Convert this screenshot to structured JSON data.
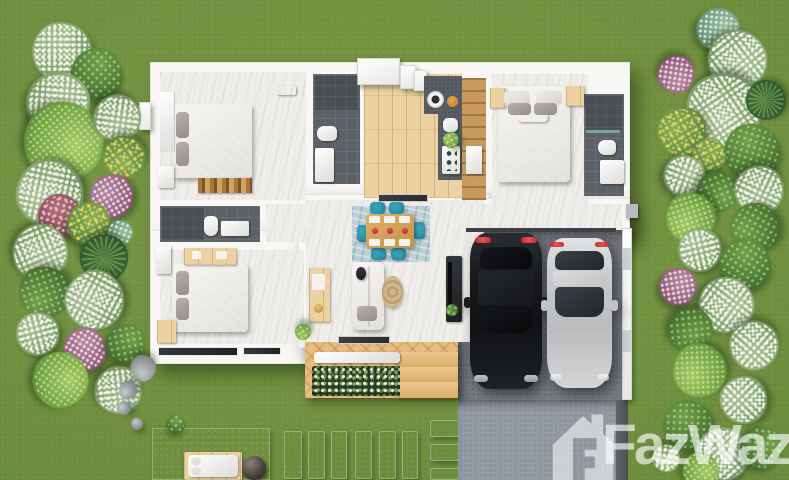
{
  "watermark": {
    "text": "FazWaz",
    "logo": "fazwaz-house-logo",
    "color": "#ffffff",
    "opacity": 0.55
  },
  "palette": {
    "grassLight": "#7a9a46",
    "grass": "#6d8d3d",
    "grassDark": "#5c7c34",
    "wall": "#f8f7f4",
    "marble": "#efeeea",
    "tile": "#5b6167",
    "wood": "#ecd2a2",
    "deck": "#e6bd80",
    "counter": "#53595f",
    "carport": "#74797f",
    "driveway": "#939aa1",
    "concrete": "#abadaf",
    "teal": "#2f93a8",
    "pantry": "#c89a5f",
    "tailRed": "#c0272d",
    "carBlack": "#16181c",
    "carSilver": "#c7c9cb",
    "jute": "#c9ad80"
  },
  "scene": {
    "type": "top-down 3d floor plan render",
    "rooms": [
      "bedroom-1",
      "bathroom-1",
      "bedroom-2",
      "bathroom-2",
      "kitchen",
      "bedroom-3",
      "ensuite-bathroom",
      "living-dining",
      "carport",
      "deck",
      "terrace"
    ],
    "vehicles": [
      "black-car",
      "silver-car"
    ]
  },
  "garden": {
    "plants": [
      [
        62,
        52,
        30,
        "white"
      ],
      [
        97,
        74,
        26,
        "green"
      ],
      [
        58,
        104,
        32,
        "white"
      ],
      [
        63,
        142,
        40,
        "bright"
      ],
      [
        117,
        118,
        24,
        "white"
      ],
      [
        124,
        157,
        22,
        "yellow"
      ],
      [
        50,
        193,
        34,
        "white"
      ],
      [
        112,
        196,
        22,
        "purple"
      ],
      [
        60,
        216,
        22,
        "purple2"
      ],
      [
        89,
        224,
        22,
        "yellow"
      ],
      [
        120,
        233,
        13,
        "teal"
      ],
      [
        40,
        252,
        28,
        "white"
      ],
      [
        104,
        258,
        24,
        "palm"
      ],
      [
        45,
        292,
        26,
        "green"
      ],
      [
        95,
        300,
        30,
        "white"
      ],
      [
        38,
        334,
        22,
        "white"
      ],
      [
        85,
        350,
        22,
        "purple"
      ],
      [
        126,
        344,
        20,
        "green"
      ],
      [
        60,
        380,
        28,
        "bright"
      ],
      [
        118,
        390,
        24,
        "white"
      ],
      [
        143,
        368,
        13,
        "rock"
      ],
      [
        128,
        390,
        9,
        "rock"
      ],
      [
        124,
        408,
        7,
        "rock"
      ],
      [
        137,
        424,
        6,
        "rock"
      ],
      [
        176,
        424,
        9,
        "green"
      ],
      [
        718,
        30,
        22,
        "teal"
      ],
      [
        737,
        60,
        30,
        "white"
      ],
      [
        676,
        74,
        19,
        "purple"
      ],
      [
        724,
        110,
        38,
        "white"
      ],
      [
        766,
        100,
        20,
        "palm"
      ],
      [
        682,
        132,
        25,
        "yellow"
      ],
      [
        752,
        152,
        28,
        "green"
      ],
      [
        709,
        155,
        17,
        "yellow"
      ],
      [
        684,
        176,
        21,
        "white"
      ],
      [
        717,
        192,
        21,
        "green"
      ],
      [
        759,
        190,
        25,
        "white"
      ],
      [
        691,
        217,
        25,
        "bright"
      ],
      [
        755,
        228,
        25,
        "green"
      ],
      [
        700,
        250,
        22,
        "white"
      ],
      [
        745,
        265,
        26,
        "green"
      ],
      [
        678,
        287,
        19,
        "purple"
      ],
      [
        726,
        305,
        28,
        "white"
      ],
      [
        690,
        330,
        23,
        "green"
      ],
      [
        754,
        345,
        25,
        "white"
      ],
      [
        700,
        370,
        27,
        "bright"
      ],
      [
        744,
        400,
        24,
        "white"
      ],
      [
        688,
        425,
        25,
        "green"
      ],
      [
        722,
        455,
        27,
        "white"
      ],
      [
        762,
        448,
        22,
        "green"
      ],
      [
        700,
        470,
        18,
        "bright"
      ],
      [
        666,
        458,
        14,
        "white"
      ],
      [
        303,
        332,
        8,
        "bright"
      ],
      [
        452,
        310,
        6,
        "green"
      ],
      [
        451,
        140,
        8,
        "bright"
      ]
    ]
  },
  "hardscape": {
    "stones": [
      [
        284,
        431,
        18,
        48
      ],
      [
        308,
        431,
        17,
        48
      ],
      [
        331,
        431,
        16,
        48
      ],
      [
        355,
        431,
        17,
        48
      ],
      [
        379,
        431,
        17,
        48
      ],
      [
        402,
        431,
        16,
        48
      ],
      [
        430,
        420,
        33,
        17
      ],
      [
        430,
        444,
        33,
        17
      ],
      [
        430,
        468,
        33,
        12
      ]
    ]
  }
}
